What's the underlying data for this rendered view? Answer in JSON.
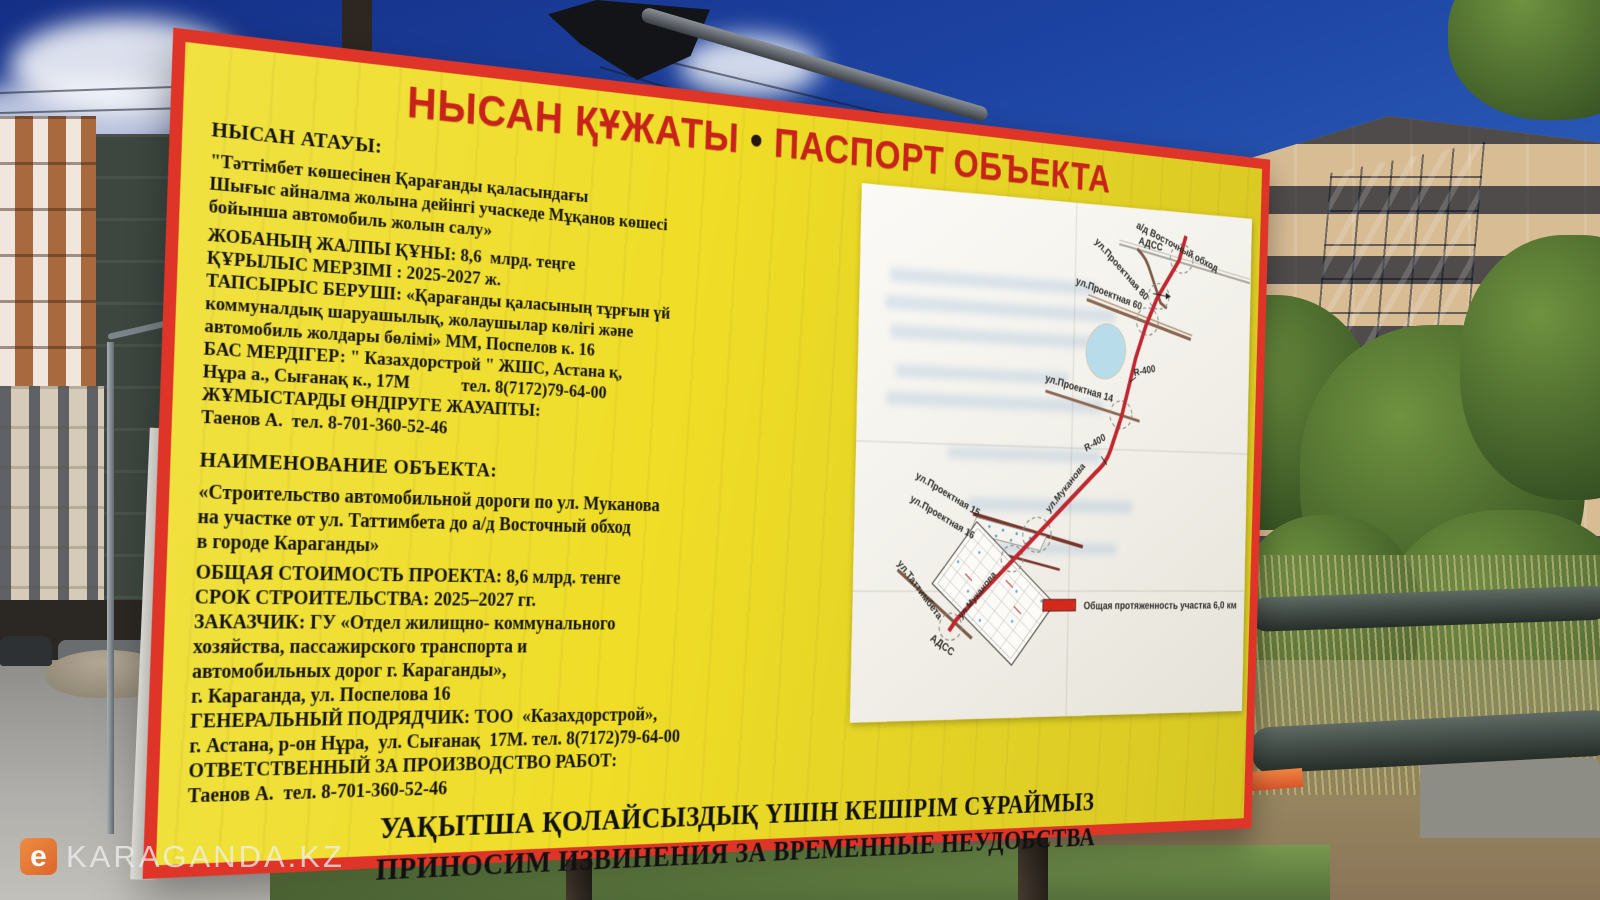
{
  "watermark": {
    "logo": "e",
    "text": "KARAGANDA.KZ"
  },
  "billboard": {
    "title_kz": "НЫСАН ҚҰЖАТЫ",
    "title_sep": "•",
    "title_ru": "ПАСПОРТ ОБЪЕКТА",
    "kz": {
      "header": "НЫСАН АТАУЫ:",
      "lines": [
        "\"Тәттімбет көшесінен Қарағанды қаласындағы",
        "Шығыс айналма жолына дейінгі учаскеде Мұқанов көшесі",
        "бойынша автомобиль жолын салу»",
        "ЖОБАНЫҢ ЖАЛПЫ ҚҰНЫ: 8,6  млрд. теңге",
        "ҚҰРЫЛЫС МЕРЗІМІ : 2025-2027 ж.",
        "ТАПСЫРЫС БЕРУШІ: «Қарағанды қаласының тұрғын үй",
        "коммуналдық шаруашылық, жолаушылар көлігі және",
        "автомобиль жолдары бөлімі» ММ, Поспелов к. 16",
        "БАС МЕРДІГЕР: \" Казахдорстрой \" ЖШС, Астана қ,",
        "Нұра а., Сығанақ к., 17М            тел. 8(7172)79-64-00",
        "ЖҰМЫСТАРДЫ ӨНДІРУГЕ ЖАУАПТЫ:",
        "Таенов А.  тел. 8-701-360-52-46"
      ]
    },
    "ru": {
      "header": "НАИМЕНОВАНИЕ ОБЪЕКТА:",
      "lines": [
        "«Строительство автомобильной дороги по ул. Муканова",
        "на участке от ул. Таттимбета до а/д Восточный обход",
        "в городе Караганды»",
        "ОБЩАЯ СТОИМОСТЬ ПРОЕКТА: 8,6 млрд. тенге",
        "СРОК СТРОИТЕЛЬСТВА: 2025–2027 гг.",
        "ЗАКАЗЧИК: ГУ «Отдел жилищно- коммунального",
        "хозяйства, пассажирского транспорта и",
        "автомобильных дорог г. Караганды»,",
        "г. Караганда, ул. Поспелова 16",
        "ГЕНЕРАЛЬНЫЙ ПОДРЯДЧИК: ТОО  «Казахдорстрой»,",
        "г. Астана, р-он Нұра,  ул. Сығанақ  17М. тел. 8(7172)79-64-00",
        "ОТВЕТСТВЕННЫЙ ЗА ПРОИЗВОДСТВО РАБОТ:",
        "Таенов А.  тел. 8-701-360-52-46"
      ]
    },
    "footer": {
      "kz": "УАҚЫТША ҚОЛАЙСЫЗДЫҚ ҮШІН КЕШІРІМ СҰРАЙМЫЗ",
      "ru": "ПРИНОСИМ ИЗВИНЕНИЯ ЗА ВРЕМЕННЫЕ НЕУДОБСТВА"
    }
  },
  "map": {
    "labels": {
      "bypass": "а/д Восточный обход",
      "adss": "АДСС",
      "pr80": "ул.Проектная 80",
      "pr60": "ул.Проектная 60",
      "r400": "R-400",
      "pr14": "ул.Проектная 14",
      "mukanova": "ул.Муканова",
      "pr15": "ул.Проектная 15",
      "pr16": "ул.Проектная 16",
      "tattimbeta": "ул.Таттимбета"
    },
    "legend": "Общая протяженность участка 6,0 км"
  },
  "colors": {
    "board_yellow": "#efdd27",
    "board_border": "#df3528",
    "title_red": "#c8221a",
    "route_red": "#bf2830",
    "lake_blue": "#b9dcea",
    "legend_red": "#d42a1e"
  }
}
